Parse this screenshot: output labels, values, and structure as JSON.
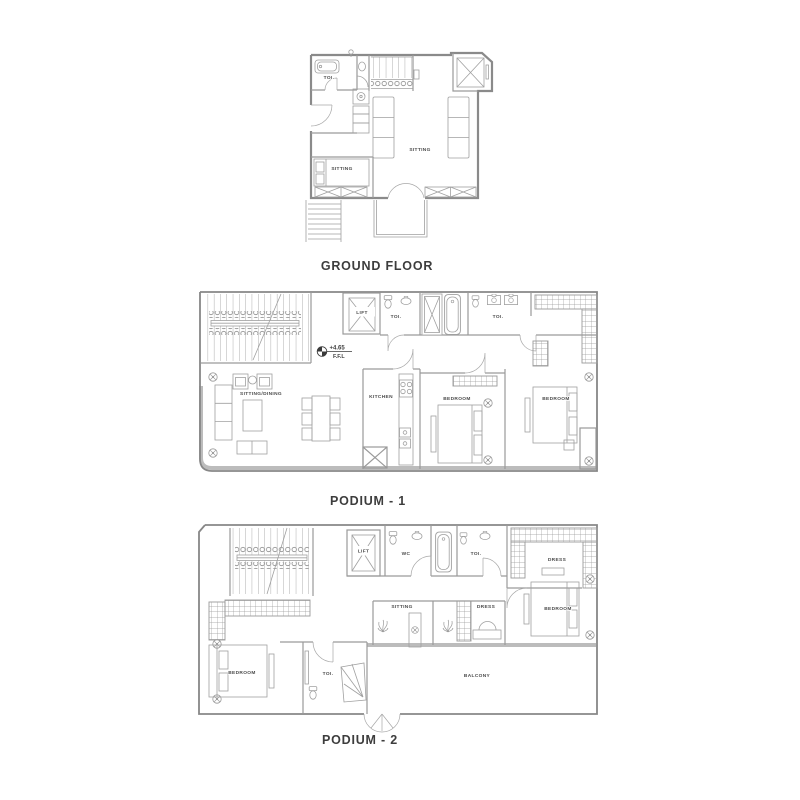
{
  "colors": {
    "background": "#ffffff",
    "wall": "#8a8a8a",
    "fixture": "#a0a0a0",
    "band": "#bcbcbc",
    "label_text": "#4a4a4a",
    "title_text": "#3d3d3d"
  },
  "ground_floor": {
    "title": "GROUND FLOOR",
    "labels": {
      "toi": "TOI.",
      "sitting_main": "SITTING",
      "sitting_small": "SITTING"
    }
  },
  "podium_1": {
    "title": "PODIUM - 1",
    "level_marker": {
      "value": "+4.65",
      "datum": "F.F.L"
    },
    "labels": {
      "lift": "LIFT",
      "toi_left": "TOI.",
      "toi_right": "TOI.",
      "sitting_dining": "SITTING/DINING",
      "kitchen": "KITCHEN",
      "bedroom_center": "BEDROOM",
      "bedroom_right": "BEDROOM"
    }
  },
  "podium_2": {
    "title": "PODIUM - 2",
    "labels": {
      "lift": "LIFT",
      "wc": "WC",
      "toi_top": "TOI.",
      "dress_top": "DRESS",
      "sitting": "SITTING",
      "dress_middle": "DRESS",
      "bedroom_right": "BEDROOM",
      "bedroom_left": "BEDROOM",
      "toi_bottom": "TOI.",
      "balcony": "BALCONY"
    }
  }
}
